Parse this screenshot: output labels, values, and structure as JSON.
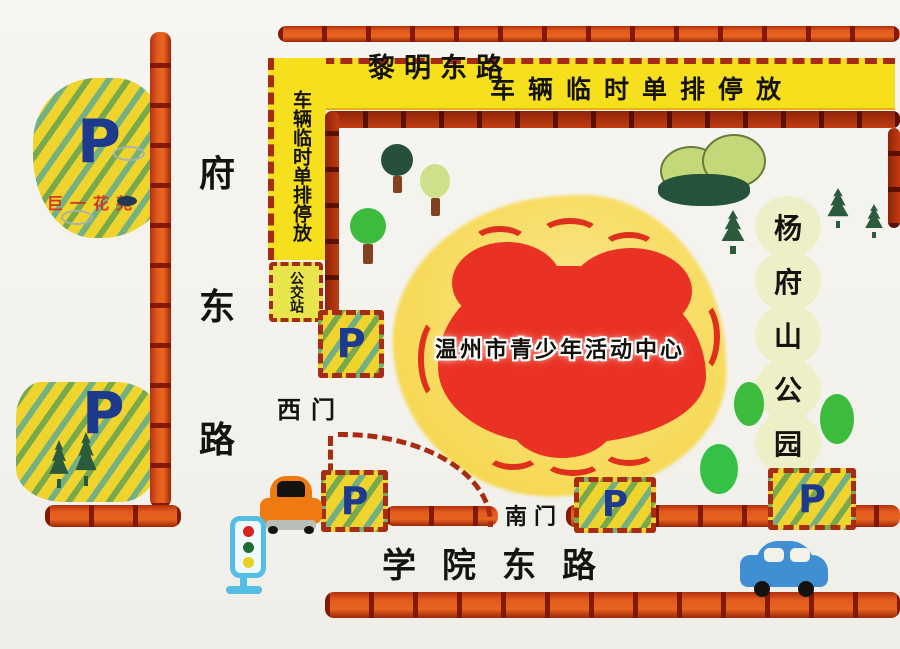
{
  "colors": {
    "road_orange": "#e25a1e",
    "road_dark_red": "#9e2507",
    "banner_yellow": "#f6df1c",
    "parking_yellow": "#f0d42e",
    "p_blue": "#1d3a8d",
    "stripe_green": "#63a252",
    "stripe_teal": "#54a896",
    "center_red": "#e93223",
    "center_yellow": "#f8dd66",
    "park_pale_green": "#edefc6",
    "ink_black": "#15130f",
    "juyi_label_red": "#cd3a26"
  },
  "roads": {
    "liming_east": "黎明东路",
    "fudong": {
      "chars": [
        "府",
        "东",
        "路"
      ]
    },
    "xueyuan_east": "学院东路"
  },
  "banners": {
    "roadside_parking_top": "车辆临时单排停放",
    "roadside_parking_left": "车辆临时单排停放",
    "bus_station": "公交站"
  },
  "gates": {
    "west": "西门",
    "south": "南门"
  },
  "center": {
    "name": "温州市青少年活动中心"
  },
  "park": {
    "chars": [
      "杨",
      "府",
      "山",
      "公",
      "园"
    ]
  },
  "parking": {
    "symbol": "P",
    "juyi_garden": "巨一花苑"
  }
}
